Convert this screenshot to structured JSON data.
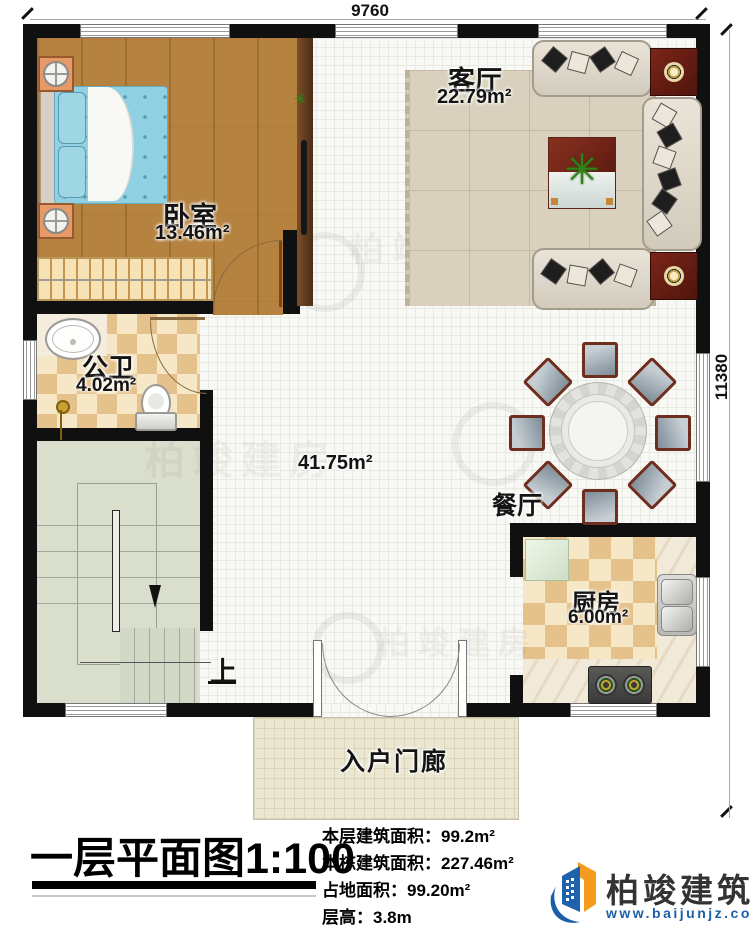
{
  "dimensions": {
    "top": "9760",
    "right": "11380"
  },
  "rooms": {
    "bedroom": {
      "name": "卧室",
      "area": "13.46m²"
    },
    "living": {
      "name": "客厅",
      "area": "22.79m²"
    },
    "bathroom": {
      "name": "公卫",
      "area": "4.02m²"
    },
    "hall": {
      "area": "41.75m²"
    },
    "dining": {
      "name": "餐厅"
    },
    "kitchen": {
      "name": "厨房",
      "area": "6.00m²"
    },
    "porch": {
      "name": "入户门廊"
    },
    "stairs": {
      "up_label": "上"
    }
  },
  "footer": {
    "title": "一层平面图",
    "scale": "1:100",
    "stats": [
      {
        "label": "本层建筑面积：",
        "value": "99.2m²"
      },
      {
        "label": "本栋建筑面积：",
        "value": "227.46m²"
      },
      {
        "label": "占地面积：",
        "value": "99.20m²"
      },
      {
        "label": "层高：",
        "value": "3.8m"
      }
    ]
  },
  "brand": {
    "name": "柏竣建筑",
    "url": "www.baijunjz.com"
  },
  "watermark": {
    "text": "柏竣建房"
  }
}
